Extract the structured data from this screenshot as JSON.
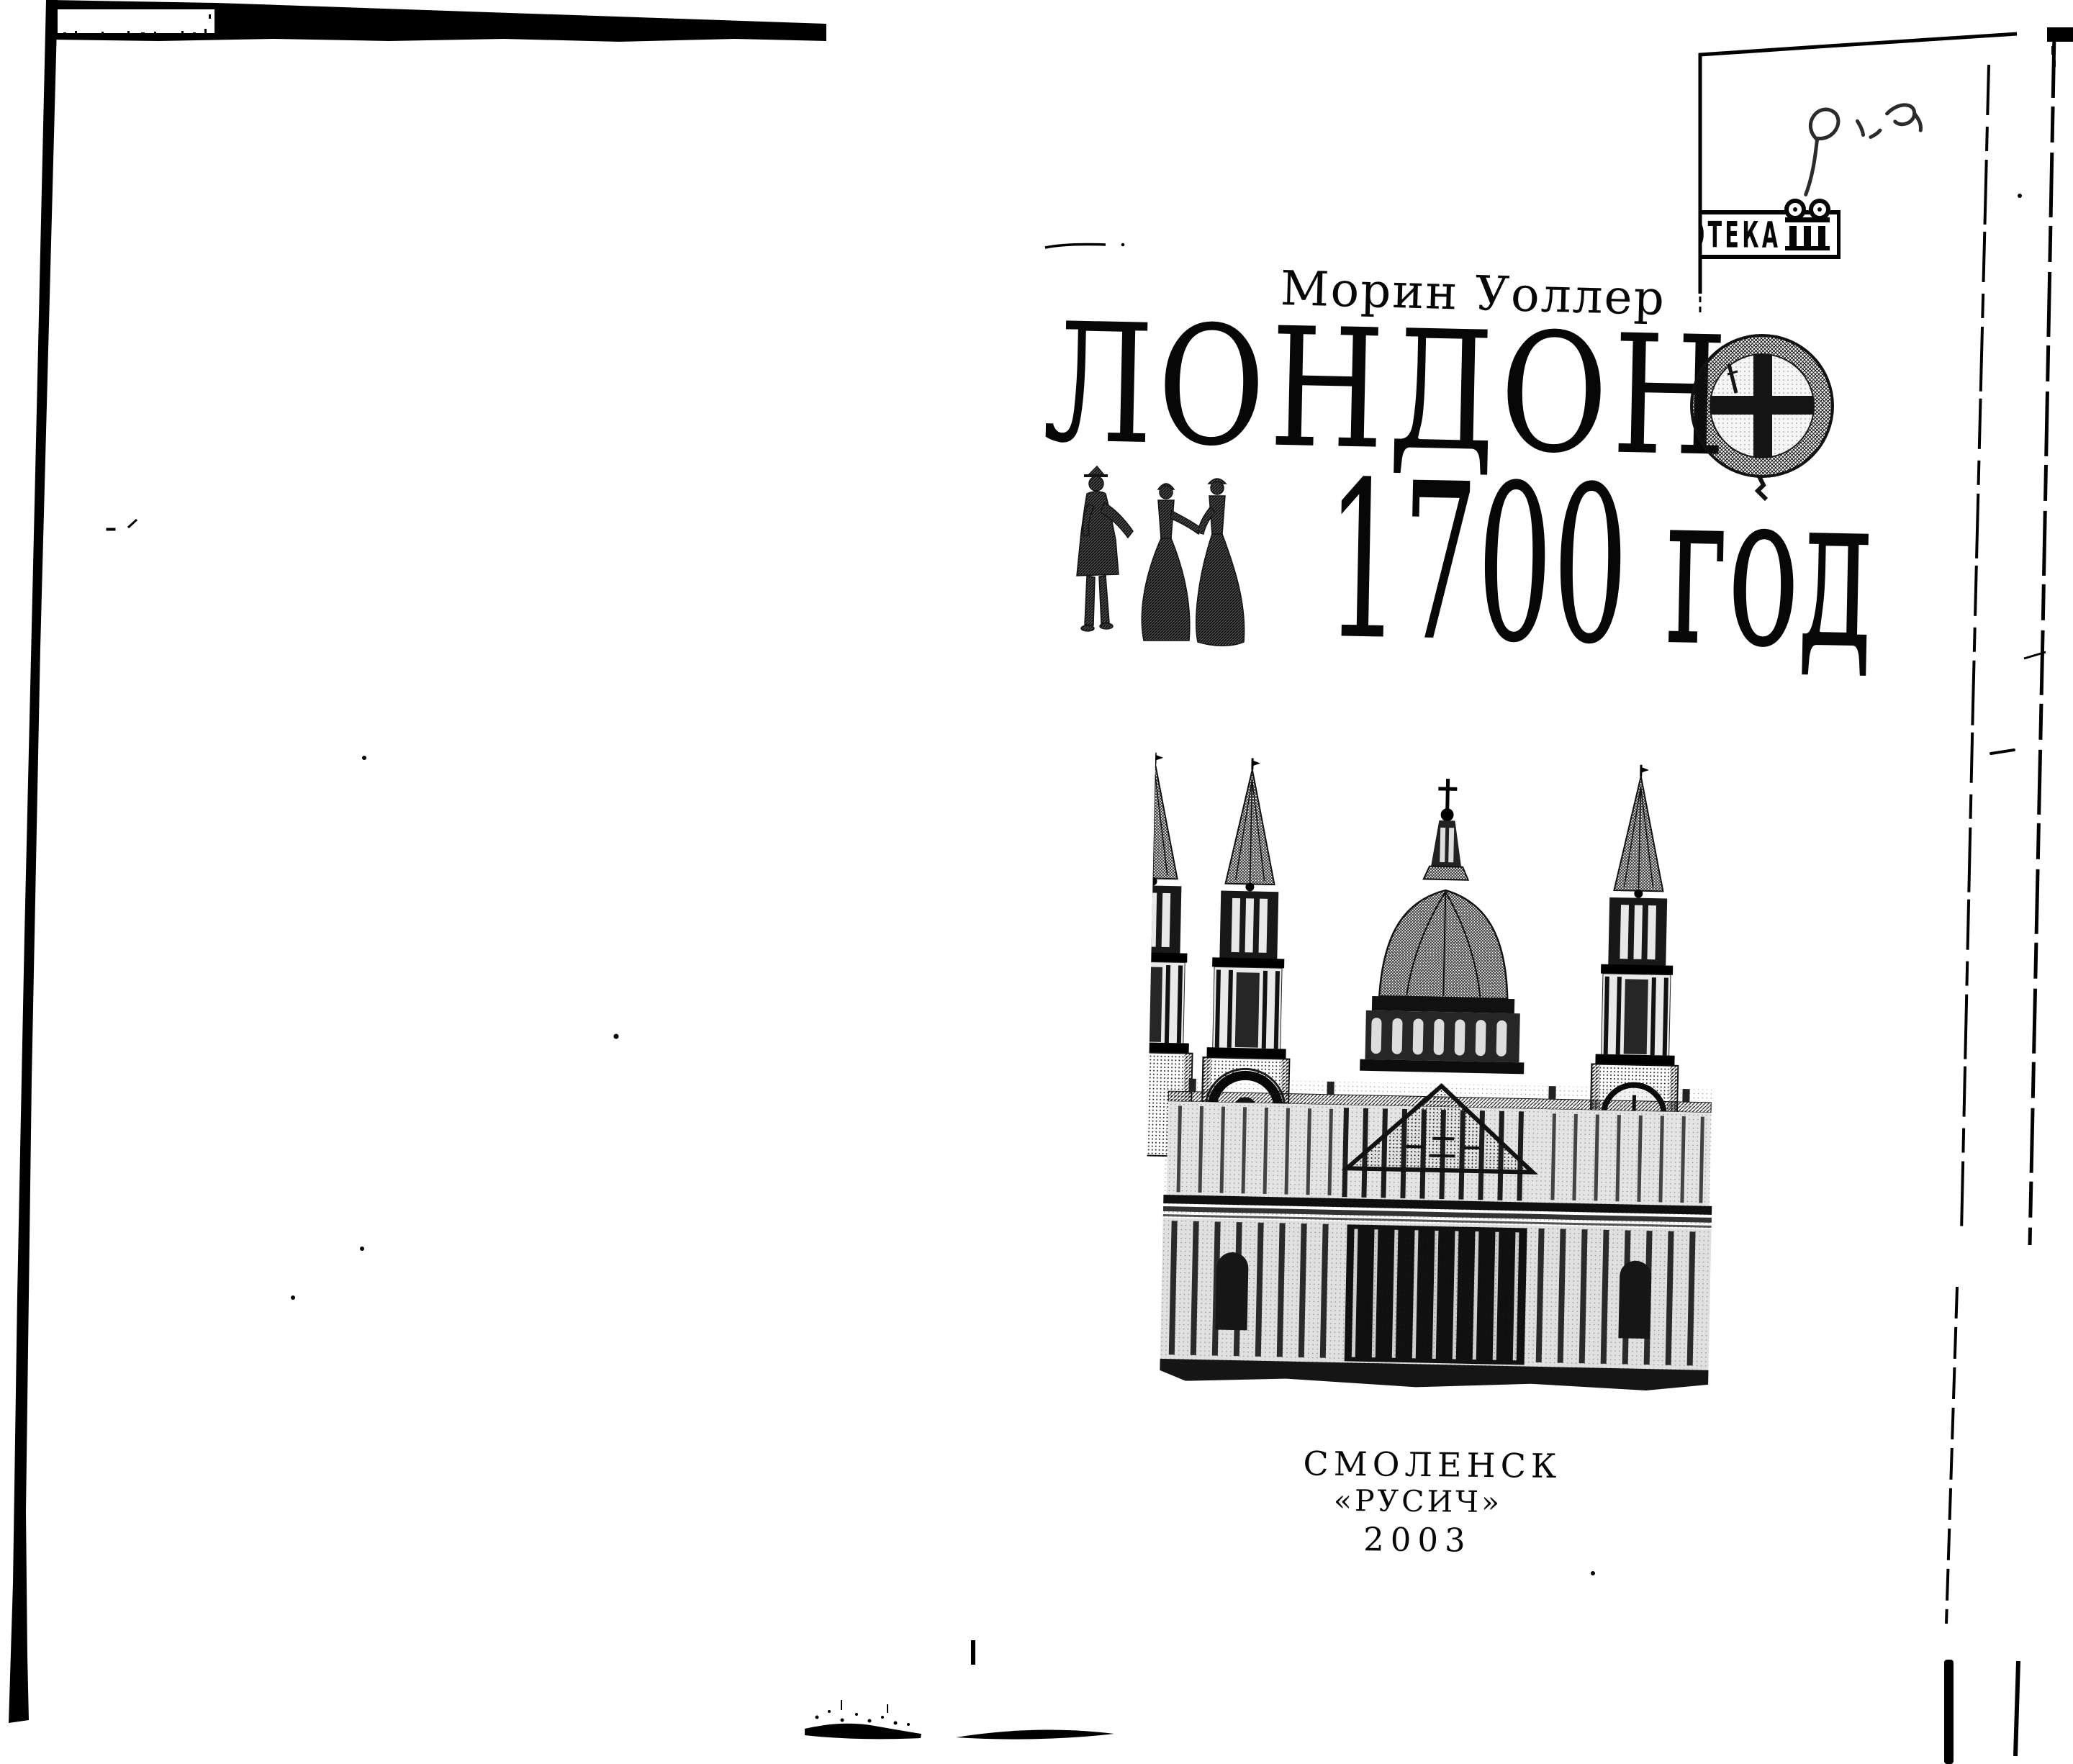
{
  "document": {
    "author": "Морин Уоллер",
    "title": "ЛОНДОН",
    "year_line": "1700 год",
    "imprint": {
      "city": "СМОЛЕНСК",
      "publisher": "«РУСИЧ»",
      "year": "2003"
    }
  },
  "stamp": {
    "visible_text": "ОТЕКА",
    "icon": "column-icon"
  },
  "graphics": {
    "medallion": "seal-with-cross",
    "figures": "three-period-figures",
    "building": "st-pauls-cathedral-engraving"
  },
  "colors": {
    "ink": "#000000",
    "paper": "#ffffff",
    "pencil": "#2b2b2b"
  }
}
